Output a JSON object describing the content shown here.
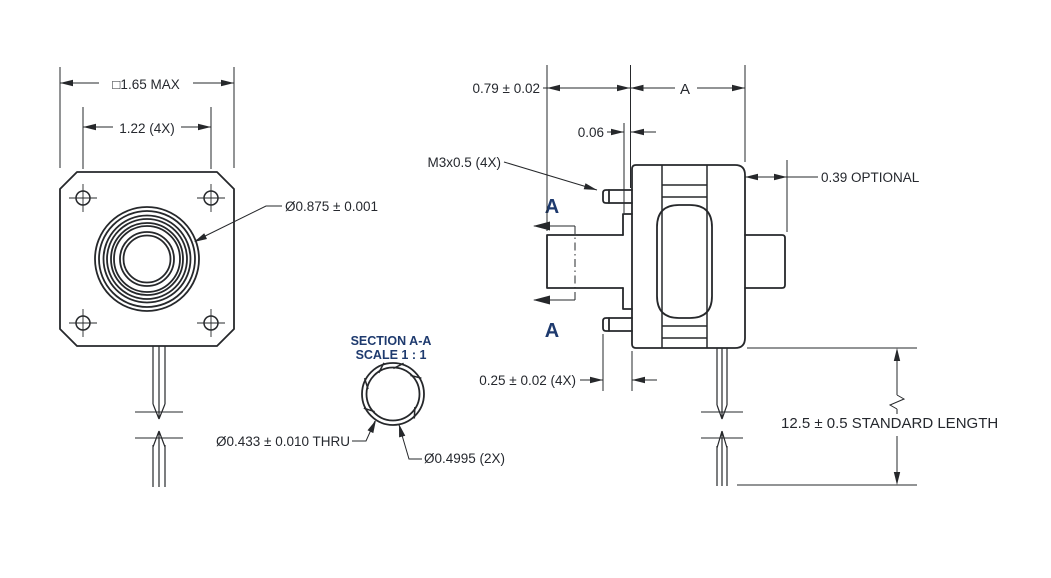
{
  "colors": {
    "line": "#26282b",
    "text": "#25282e",
    "section_text": "#1e3a6e",
    "background": "#ffffff"
  },
  "front_view": {
    "dim_overall": "□1.65 MAX",
    "dim_hole_spacing": "1.22 (4X)",
    "dim_pilot_diameter": "Ø0.875 ± 0.001"
  },
  "section_view": {
    "title": "SECTION A-A",
    "scale": "SCALE 1 : 1",
    "dim_bore": "Ø0.433 ± 0.010 THRU",
    "dim_shaft_diameter": "Ø0.4995 (2X)"
  },
  "side_view": {
    "dim_shaft_length": "0.79 ± 0.02",
    "dim_body_length": "A",
    "dim_pilot_depth": "0.06",
    "dim_mounting_thread": "M3x0.5 (4X)",
    "dim_rear_boss": "0.39 OPTIONAL",
    "dim_flange_depth": "0.25 ± 0.02 (4X)",
    "dim_lead_length": "12.5 ± 0.5 STANDARD LENGTH",
    "section_arrow_top": "A",
    "section_arrow_bottom": "A"
  }
}
